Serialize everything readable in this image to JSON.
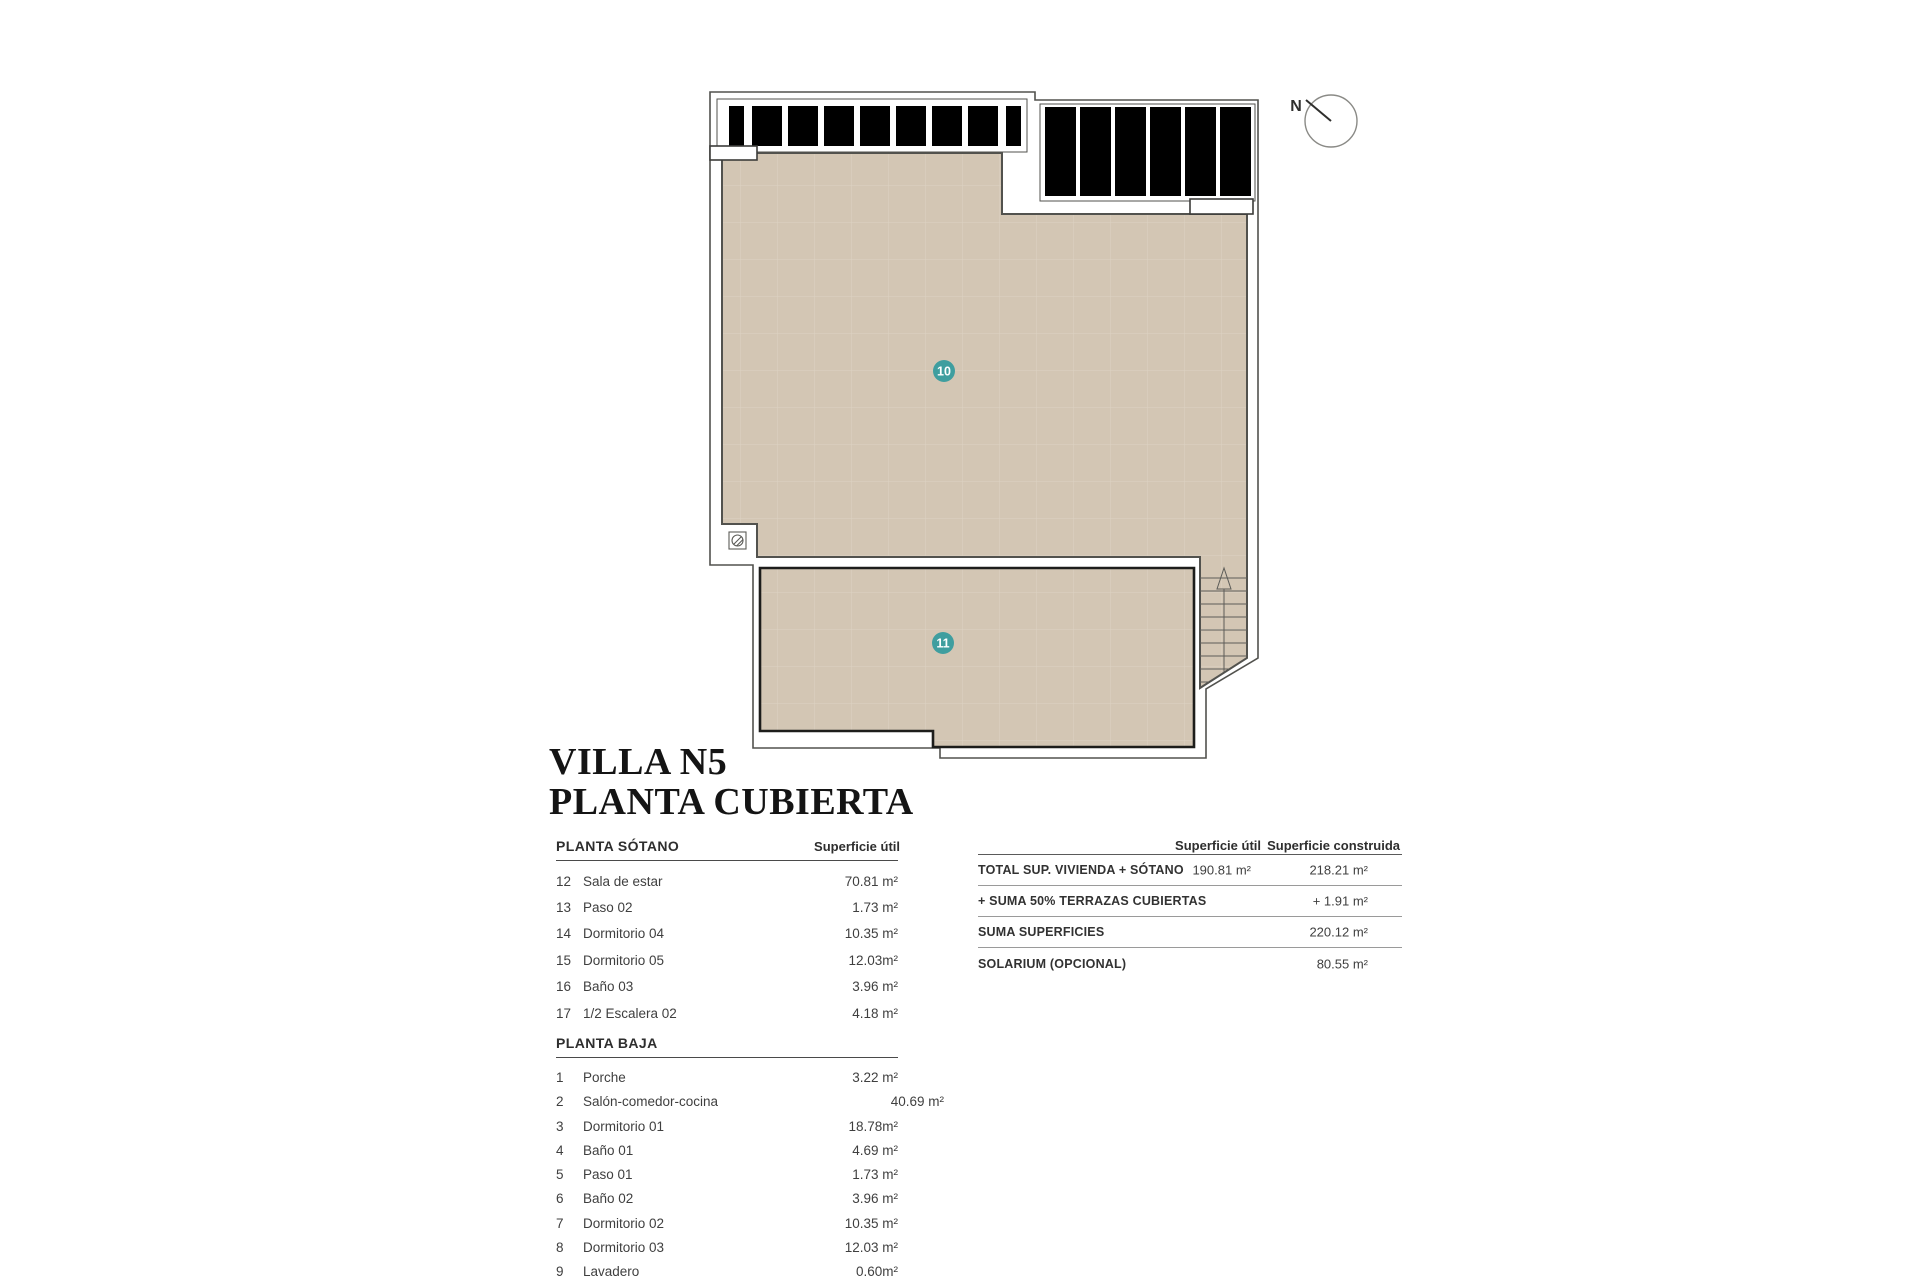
{
  "title": {
    "line1": "VILLA N5",
    "line2": "PLANTA CUBIERTA"
  },
  "plan": {
    "north_label": "N",
    "area_labels": [
      {
        "number": "10"
      },
      {
        "number": "11"
      }
    ],
    "colors": {
      "tile_fill": "#d3c6b4",
      "tile_grid": "#ddd3c3",
      "outline": "#52524e",
      "terrace_border": "#1d1d1b",
      "label_teal": "#3f9e9f"
    }
  },
  "tables": {
    "sotano": {
      "header": "PLANTA SÓTANO",
      "col_header": "Superficie útil",
      "rows": [
        {
          "num": "12",
          "name": "Sala de estar",
          "value": "70.81 m²"
        },
        {
          "num": "13",
          "name": "Paso 02",
          "value": "1.73 m²"
        },
        {
          "num": "14",
          "name": "Dormitorio 04",
          "value": "10.35 m²"
        },
        {
          "num": "15",
          "name": "Dormitorio 05",
          "value": "12.03m²"
        },
        {
          "num": "16",
          "name": "Baño 03",
          "value": "3.96 m²"
        },
        {
          "num": "17",
          "name": "1/2 Escalera 02",
          "value": "4.18 m²"
        }
      ]
    },
    "baja": {
      "header": "PLANTA BAJA",
      "rows": [
        {
          "num": "1",
          "name": "Porche",
          "value": "3.22 m²"
        },
        {
          "num": "2",
          "name": "Salón-comedor-cocina",
          "value": "40.69 m²"
        },
        {
          "num": "3",
          "name": "Dormitorio 01",
          "value": "18.78m²"
        },
        {
          "num": "4",
          "name": "Baño 01",
          "value": "4.69 m²"
        },
        {
          "num": "5",
          "name": "Paso 01",
          "value": "1.73 m²"
        },
        {
          "num": "6",
          "name": "Baño 02",
          "value": "3.96 m²"
        },
        {
          "num": "7",
          "name": "Dormitorio 02",
          "value": "10.35 m²"
        },
        {
          "num": "8",
          "name": "Dormitorio 03",
          "value": "12.03 m²"
        },
        {
          "num": "9",
          "name": "Lavadero",
          "value": "0.60m²"
        }
      ]
    },
    "summary": {
      "col1_header": "Superficie útil",
      "col2_header": "Superficie construida",
      "rows": [
        {
          "label": "TOTAL SUP. VIVIENDA + SÓTANO",
          "util": "190.81  m²",
          "construida": "218.21 m²"
        },
        {
          "label": "+ SUMA 50% TERRAZAS CUBIERTAS",
          "util": "",
          "construida": "+ 1.91 m²"
        },
        {
          "label": "SUMA SUPERFICIES",
          "util": "",
          "construida": "220.12 m²"
        },
        {
          "label": "SOLARIUM (OPCIONAL)",
          "util": "",
          "construida": "80.55 m²"
        }
      ]
    }
  }
}
